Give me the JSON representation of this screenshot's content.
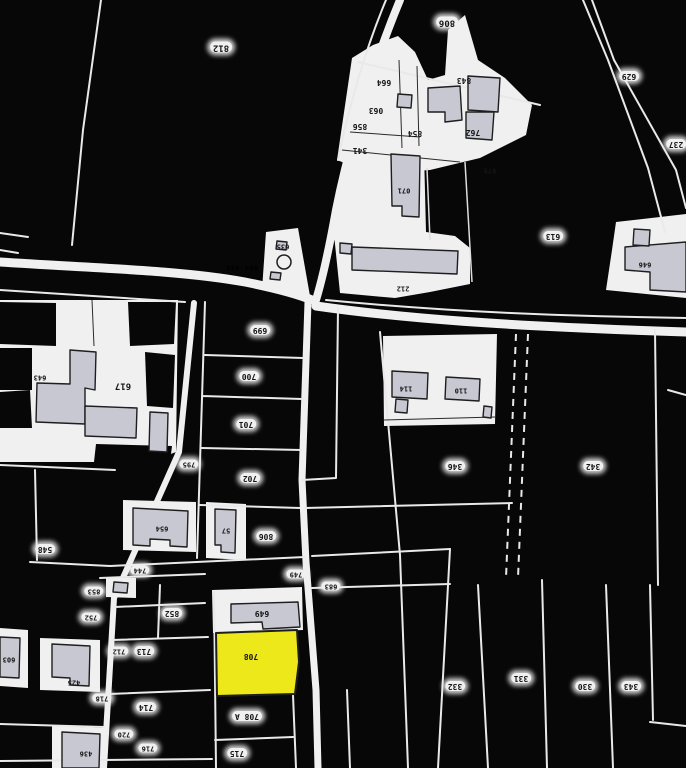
{
  "map": {
    "kind": "cadastral-parcel-plan-scan",
    "orientation_note": "labels printed rotated 180deg",
    "highlighted_parcel": "708",
    "colors": {
      "background": "#070707",
      "paper": "#f0f0f0",
      "building_fill": "#c8c8d3",
      "highlight_fill": "#ece81a",
      "ink": "#1e1e1e"
    },
    "parcel_labels": [
      {
        "text": "812",
        "x": 221,
        "y": 47,
        "bg": 1,
        "fs": 9
      },
      {
        "text": "806",
        "x": 447,
        "y": 22,
        "bg": 1,
        "fs": 9
      },
      {
        "text": "629",
        "x": 629,
        "y": 76,
        "bg": 1
      },
      {
        "text": "237",
        "x": 676,
        "y": 144,
        "bg": 1
      },
      {
        "text": "664",
        "x": 384,
        "y": 82
      },
      {
        "text": "063",
        "x": 376,
        "y": 110
      },
      {
        "text": "856",
        "x": 360,
        "y": 126
      },
      {
        "text": "854",
        "x": 415,
        "y": 133
      },
      {
        "text": "843",
        "x": 464,
        "y": 80
      },
      {
        "text": "762",
        "x": 473,
        "y": 132
      },
      {
        "text": "341",
        "x": 360,
        "y": 150
      },
      {
        "text": "879",
        "x": 490,
        "y": 170,
        "fs": 7
      },
      {
        "text": "071",
        "x": 404,
        "y": 190,
        "fs": 7
      },
      {
        "text": "635",
        "x": 283,
        "y": 246,
        "fs": 7
      },
      {
        "text": "212",
        "x": 403,
        "y": 288,
        "fs": 7
      },
      {
        "text": "864-448",
        "x": 242,
        "y": 267,
        "road": 1
      },
      {
        "text": "613",
        "x": 553,
        "y": 236,
        "bg": 1
      },
      {
        "text": "646",
        "x": 645,
        "y": 264,
        "fs": 7
      },
      {
        "text": "643",
        "x": 40,
        "y": 377,
        "fs": 7
      },
      {
        "text": "617",
        "x": 123,
        "y": 385,
        "bg": 1,
        "fs": 9
      },
      {
        "text": "699",
        "x": 260,
        "y": 330,
        "bg": 1
      },
      {
        "text": "700",
        "x": 249,
        "y": 376,
        "bg": 1
      },
      {
        "text": "701",
        "x": 246,
        "y": 424,
        "bg": 1
      },
      {
        "text": "702",
        "x": 250,
        "y": 478,
        "bg": 1
      },
      {
        "text": "795",
        "x": 189,
        "y": 464,
        "bg": 1,
        "fs": 7
      },
      {
        "text": "114",
        "x": 406,
        "y": 388,
        "fs": 7
      },
      {
        "text": "110",
        "x": 461,
        "y": 390,
        "fs": 7
      },
      {
        "text": "346",
        "x": 455,
        "y": 466,
        "bg": 1
      },
      {
        "text": "342",
        "x": 593,
        "y": 466,
        "bg": 1
      },
      {
        "text": "548",
        "x": 45,
        "y": 549,
        "bg": 1
      },
      {
        "text": "654",
        "x": 162,
        "y": 528,
        "fs": 7
      },
      {
        "text": "57",
        "x": 226,
        "y": 530,
        "fs": 7
      },
      {
        "text": "806",
        "x": 266,
        "y": 536,
        "bg": 1
      },
      {
        "text": "744",
        "x": 140,
        "y": 570,
        "bg": 1,
        "fs": 7
      },
      {
        "text": "749",
        "x": 296,
        "y": 574,
        "bg": 1,
        "fs": 7
      },
      {
        "text": "683",
        "x": 331,
        "y": 586,
        "bg": 1,
        "fs": 7
      },
      {
        "text": "853",
        "x": 94,
        "y": 591,
        "bg": 1,
        "fs": 7
      },
      {
        "text": "752",
        "x": 91,
        "y": 617,
        "bg": 1,
        "fs": 7
      },
      {
        "text": "852",
        "x": 172,
        "y": 613,
        "bg": 1
      },
      {
        "text": "712",
        "x": 119,
        "y": 651,
        "bg": 1,
        "fs": 7
      },
      {
        "text": "713",
        "x": 144,
        "y": 651,
        "bg": 1
      },
      {
        "text": "718",
        "x": 102,
        "y": 698,
        "bg": 1,
        "fs": 7
      },
      {
        "text": "714",
        "x": 146,
        "y": 707,
        "bg": 1
      },
      {
        "text": "720",
        "x": 124,
        "y": 734,
        "bg": 1,
        "fs": 7
      },
      {
        "text": "716",
        "x": 148,
        "y": 748,
        "bg": 1,
        "fs": 7
      },
      {
        "text": "425",
        "x": 74,
        "y": 682,
        "fs": 7
      },
      {
        "text": "436",
        "x": 86,
        "y": 753,
        "fs": 7
      },
      {
        "text": "603",
        "x": 9,
        "y": 659,
        "fs": 7
      },
      {
        "text": "649",
        "x": 262,
        "y": 613
      },
      {
        "text": "708",
        "x": 251,
        "y": 656
      },
      {
        "text": "708 A",
        "x": 247,
        "y": 716,
        "bg": 1
      },
      {
        "text": "715",
        "x": 237,
        "y": 753,
        "bg": 1
      },
      {
        "text": "332",
        "x": 455,
        "y": 686,
        "bg": 1
      },
      {
        "text": "331",
        "x": 521,
        "y": 678,
        "bg": 1
      },
      {
        "text": "330",
        "x": 585,
        "y": 686,
        "bg": 1
      },
      {
        "text": "343",
        "x": 631,
        "y": 686,
        "bg": 1
      }
    ]
  }
}
